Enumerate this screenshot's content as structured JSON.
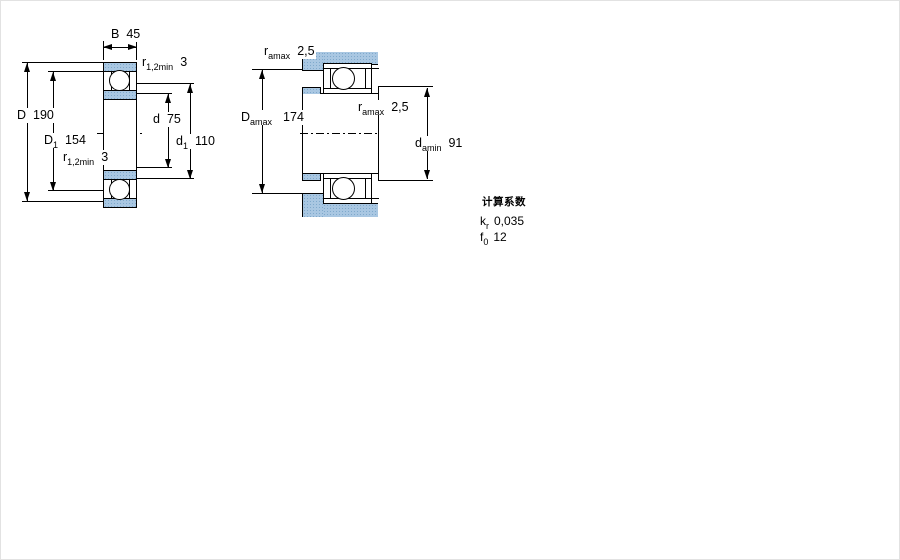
{
  "figure": {
    "description": "bearing-cross-section-dimension-drawing"
  },
  "left_diagram": {
    "labels": {
      "b": {
        "sym": "B",
        "sub": "",
        "val": "45"
      },
      "r_top": {
        "sym": "r",
        "sub": "1,2min",
        "val": "3"
      },
      "D": {
        "sym": "D",
        "sub": "",
        "val": "190"
      },
      "d": {
        "sym": "d",
        "sub": "",
        "val": "75"
      },
      "D1": {
        "sym": "D",
        "sub": "1",
        "val": "154"
      },
      "d1": {
        "sym": "d",
        "sub": "1",
        "val": "110"
      },
      "r_bottom": {
        "sym": "r",
        "sub": "1,2min",
        "val": "3"
      }
    }
  },
  "right_diagram": {
    "labels": {
      "ra_top": {
        "sym": "r",
        "sub": "amax",
        "val": "2,5"
      },
      "Da": {
        "sym": "D",
        "sub": "amax",
        "val": "174"
      },
      "ra_mid": {
        "sym": "r",
        "sub": "amax",
        "val": "2,5"
      },
      "da": {
        "sym": "d",
        "sub": "amin",
        "val": "91"
      }
    }
  },
  "calc_factors": {
    "heading": "计算系数",
    "rows": [
      {
        "sym": "k",
        "sub": "r",
        "val": "0,035"
      },
      {
        "sym": "f",
        "sub": "0",
        "val": "12"
      }
    ]
  },
  "colors": {
    "hatch_fill": "#a9c7e2",
    "hatch_dot": "#7fa9cc",
    "line": "#000000"
  }
}
